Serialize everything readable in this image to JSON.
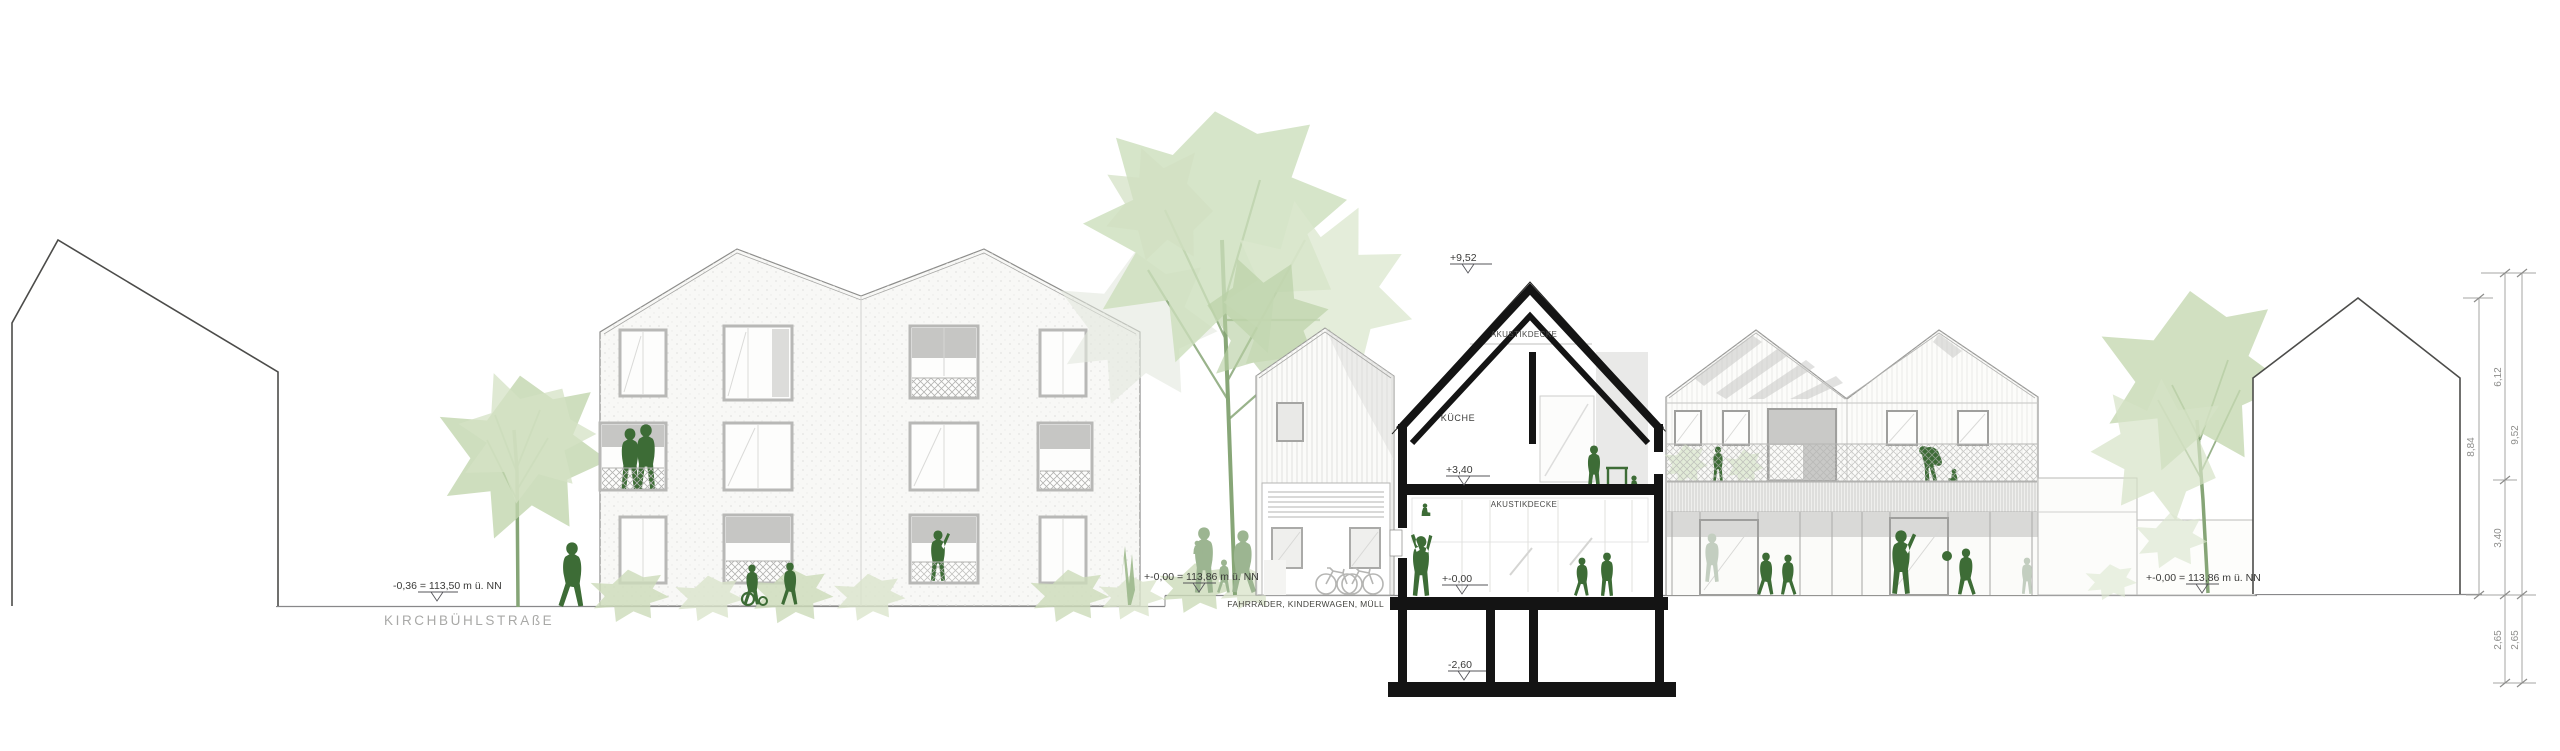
{
  "labels": {
    "street_level": "-0,36 = 113,50 m ü. NN",
    "street_name": "KIRCHBÜHLSTRAßE",
    "ground_level_left": "+-0,00 = 113,86 m ü. NN",
    "ground_level_right": "+-0,00 = 113,86 m ü. NN",
    "bike_storage": "FAHRRÄDER, KINDERWAGEN, MÜLL"
  },
  "section": {
    "ridge_level": "+9,52",
    "attic_ceiling_label": "AKUSTIKDECKE",
    "room_kitchen": "KÜCHE",
    "upper_floor_level": "+3,40",
    "ground_ceiling_label": "AKUSTIKDECKE",
    "ground_floor_level": "+-0,00",
    "basement_level": "-2,60"
  },
  "dimensions": {
    "ridge_house_height": "8,84",
    "roof_zone": "6,12",
    "total_height": "9,52",
    "ground_floor_zone": "3,40",
    "basement_inner": "2,65",
    "basement_outer": "2,65"
  },
  "colors": {
    "figure_green": "#3d6c36",
    "figure_green_muted": "#9cb591",
    "figure_ghost": "#c3cec0",
    "foliage": "#c9dcb8",
    "foliage_light": "#d9e6cb",
    "section_ink": "#141414",
    "line_gray": "#9a9a98"
  }
}
